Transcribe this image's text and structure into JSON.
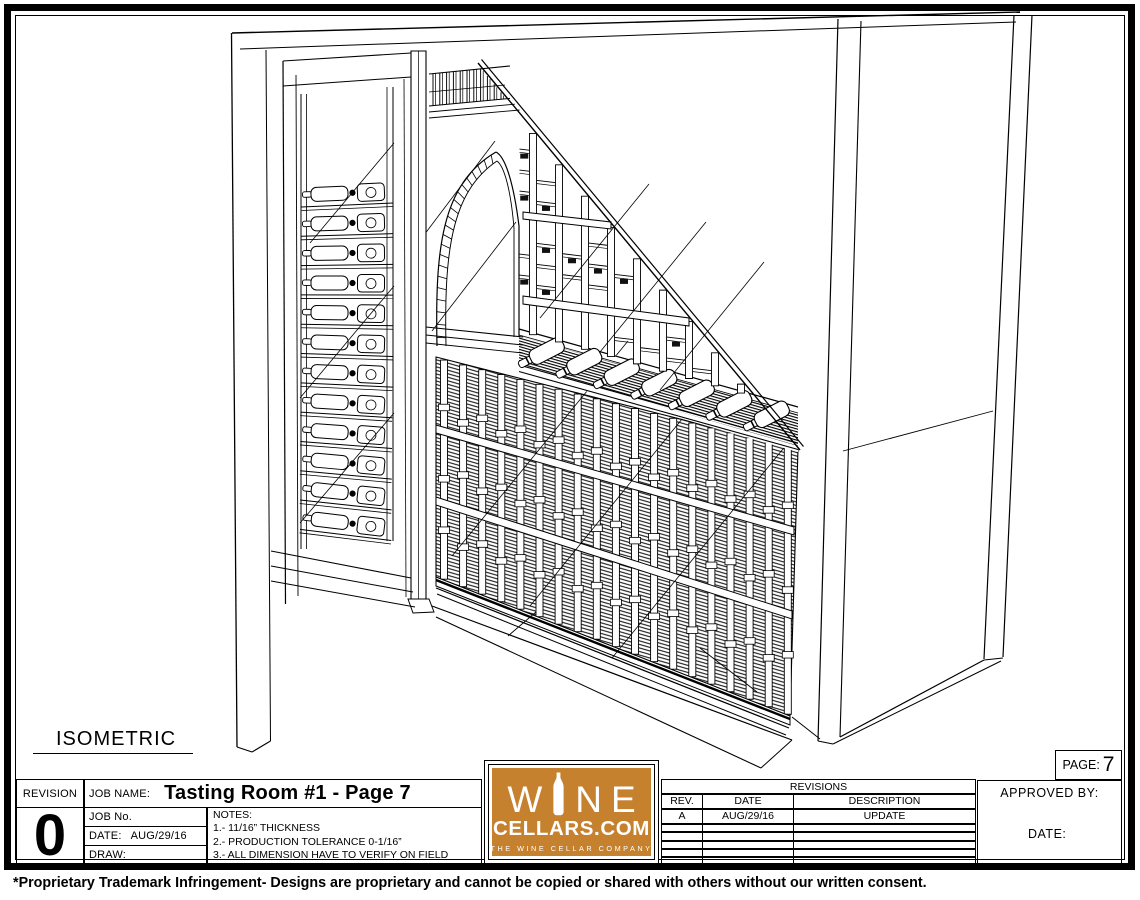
{
  "sheet": {
    "view_label": "ISOMETRIC",
    "page_label": "PAGE:",
    "page_number": "7",
    "disclaimer": "*Proprietary Trademark Infringement- Designs are proprietary and cannot be copied or shared with others without our written consent."
  },
  "title_block": {
    "revision_label": "REVISION",
    "revision_number": "0",
    "job_name_label": "JOB NAME:",
    "job_name": "Tasting Room #1 - Page 7",
    "job_no_label": "JOB No.",
    "date_label": "DATE:",
    "date_value": "AUG/29/16",
    "draw_label": "DRAW:",
    "notes_title": "NOTES:",
    "notes": [
      "1.- 11/16” THICKNESS",
      "2.- PRODUCTION TOLERANCE 0-1/16”",
      "3.- ALL DIMENSION HAVE TO VERIFY ON FIELD"
    ]
  },
  "logo": {
    "letter_w": "W",
    "letter_n": "N",
    "letter_e": "E",
    "brand": "CELLARS.COM",
    "tagline": "THE WINE CELLAR COMPANY",
    "bg_color": "#C5812E"
  },
  "revisions_table": {
    "title": "REVISIONS",
    "columns": [
      "REV.",
      "DATE",
      "DESCRIPTION"
    ],
    "rows": [
      [
        "A",
        "AUG/29/16",
        "UPDATE"
      ]
    ],
    "empty_rows": 5
  },
  "approval": {
    "approved_by_label": "APPROVED BY:",
    "date_label": "DATE:"
  },
  "colors": {
    "line": "#000000",
    "paper": "#ffffff",
    "logo_orange": "#C5812E"
  }
}
